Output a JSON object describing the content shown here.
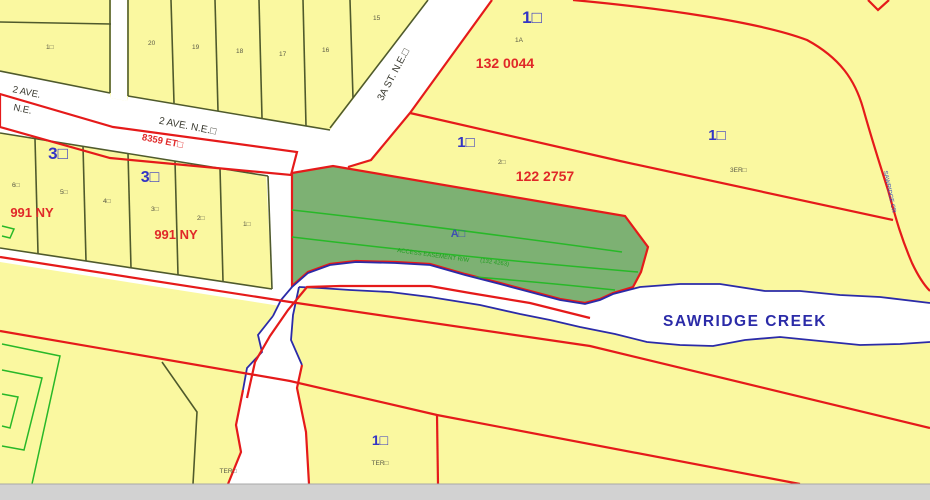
{
  "map_labels": {
    "streets": {
      "ave2_w1": "2 AVE.",
      "ave2_w2": "N.E.",
      "ave2_main": "2 AVE. N.E.□",
      "st_3a": "3A ST. N.E.□"
    },
    "plan_numbers": {
      "plan_8359": "8359 ET□",
      "plan_132_0044": "132 0044",
      "plan_122_2757": "122 2757",
      "plan_991_left": "991 NY",
      "plan_991_center": "991 NY",
      "easement": "ACCESS EASEMENT R/W",
      "easement_plan": "(132 4263)"
    },
    "blocks": {
      "top": "1□",
      "mid": "1□",
      "right": "1□",
      "bottom": "1□",
      "three_left": "3□",
      "three_center": "3□"
    },
    "parcels": {
      "a": "A□",
      "lot_1a": "1A",
      "lot_2": "2□",
      "lot_3er": "3ER□",
      "ter_a": "TER□",
      "ter_b": "TER□",
      "block_a_lot": "1□"
    },
    "lot_numbers_top": [
      "20",
      "19",
      "18",
      "17",
      "16",
      "15"
    ],
    "lot_numbers_left": [
      "6□",
      "5□",
      "4□",
      "3□",
      "2□",
      "1□"
    ],
    "creek": {
      "name": "SAWRIDGE CREEK",
      "side": "SAWRIDGE CR"
    },
    "colors": {
      "parcel_yellow": "#faf8a0",
      "parcel_green": "#7db173",
      "boundary_red": "#e51a1a",
      "label_blue": "#3335c4",
      "creek_blue": "#2b2ba8",
      "line_green": "#28b828",
      "red_text": "#e02828",
      "outside_gray": "#d2d2d2"
    }
  }
}
